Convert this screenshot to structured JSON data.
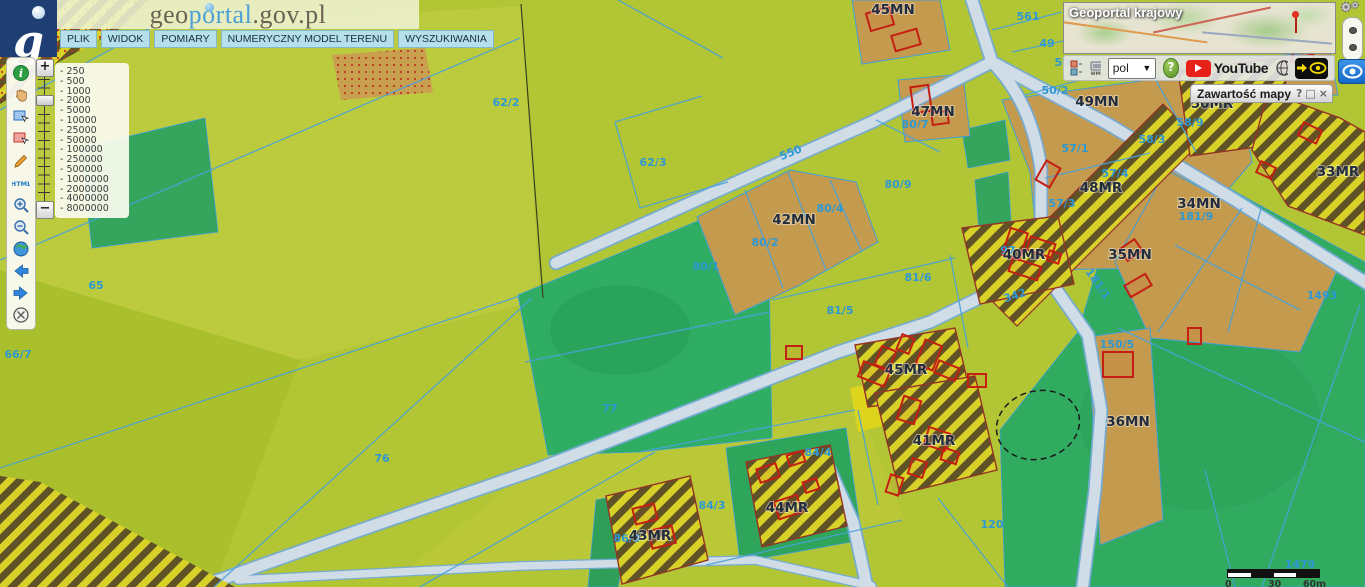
{
  "brand": {
    "logo_letter": "g",
    "site_prefix": "geo",
    "site_mid": "portal",
    "site_suffix": ".gov.pl"
  },
  "menu": {
    "items": [
      {
        "label": "PLIK"
      },
      {
        "label": "WIDOK"
      },
      {
        "label": "POMIARY"
      },
      {
        "label": "NUMERYCZNY MODEL TERENU"
      },
      {
        "label": "WYSZUKIWANIA"
      }
    ]
  },
  "left_toolbar": {
    "icons": [
      "info",
      "pan",
      "select-rectangle",
      "deselect-rectangle",
      "draw",
      "html-report",
      "zoom-in",
      "zoom-out",
      "full-extent",
      "previous-view",
      "next-view",
      "clear"
    ]
  },
  "zoom_control": {
    "plus_label": "+",
    "minus_label": "−",
    "scales": [
      "- 250",
      "- 500",
      "- 1000",
      "- 2000",
      "- 5000",
      "- 10000",
      "- 25000",
      "- 50000",
      "- 100000",
      "- 250000",
      "- 500000",
      "- 1000000",
      "- 2000000",
      "- 4000000",
      "- 8000000"
    ]
  },
  "overview": {
    "title": "Geoportal krajowy"
  },
  "top_toolbar": {
    "language_value": "pol",
    "help_label": "?",
    "youtube_label": "YouTube",
    "icons": [
      "legend-icon",
      "wms-icon",
      "language-select",
      "help-button",
      "youtube-button",
      "globe-grid-icon",
      "quick-view-arrow-icon",
      "quick-view-eye-icon"
    ]
  },
  "right_controls": {
    "icons": [
      "gears-icon",
      "panel-handle",
      "eye-icon"
    ]
  },
  "map_content_panel": {
    "title": "Zawartość mapy",
    "help_label": "?",
    "maximize_label": "□",
    "close_label": "×"
  },
  "scale_bar": {
    "labels": [
      "0",
      "30",
      "60m"
    ]
  },
  "map": {
    "colors": {
      "field": "#b2c534",
      "forest": "#2fae63",
      "residential": "#c49a4e",
      "hatch_yellow": "#d8d128",
      "hatch_dark": "#5f5226",
      "road": "#d0dce6",
      "road_edge": "#74abd6",
      "cadastral_line": "#48a2da",
      "building_outline": "#c41f12",
      "parcel_number": "#2e98d4",
      "zone_label": "#222c3c"
    },
    "zone_labels": [
      {
        "text": "45MN",
        "x": 893,
        "y": 14
      },
      {
        "text": "47MN",
        "x": 933,
        "y": 116
      },
      {
        "text": "49MN",
        "x": 1097,
        "y": 106
      },
      {
        "text": "50MR",
        "x": 1212,
        "y": 108
      },
      {
        "text": "48MR",
        "x": 1101,
        "y": 192
      },
      {
        "text": "42MN",
        "x": 794,
        "y": 224
      },
      {
        "text": "40MR",
        "x": 1024,
        "y": 259
      },
      {
        "text": "34MN",
        "x": 1199,
        "y": 208
      },
      {
        "text": "35MN",
        "x": 1130,
        "y": 259
      },
      {
        "text": "33MR",
        "x": 1338,
        "y": 176
      },
      {
        "text": "36MN",
        "x": 1128,
        "y": 426
      },
      {
        "text": "45MR",
        "x": 906,
        "y": 374
      },
      {
        "text": "41MR",
        "x": 934,
        "y": 445
      },
      {
        "text": "43MR",
        "x": 650,
        "y": 540
      },
      {
        "text": "44MR",
        "x": 787,
        "y": 512
      }
    ],
    "parcel_numbers": [
      {
        "text": "561",
        "x": 1028,
        "y": 20
      },
      {
        "text": "49",
        "x": 1047,
        "y": 47
      },
      {
        "text": "50/1",
        "x": 1068,
        "y": 66
      },
      {
        "text": "50/2",
        "x": 1055,
        "y": 94
      },
      {
        "text": "80/7",
        "x": 915,
        "y": 128
      },
      {
        "text": "80/9",
        "x": 898,
        "y": 188
      },
      {
        "text": "80/4",
        "x": 830,
        "y": 212
      },
      {
        "text": "80/2",
        "x": 765,
        "y": 246
      },
      {
        "text": "80/1",
        "x": 706,
        "y": 270
      },
      {
        "text": "81/6",
        "x": 918,
        "y": 281
      },
      {
        "text": "81/5",
        "x": 840,
        "y": 314
      },
      {
        "text": "62/2",
        "x": 506,
        "y": 106
      },
      {
        "text": "62/3",
        "x": 653,
        "y": 166
      },
      {
        "text": "65",
        "x": 96,
        "y": 289
      },
      {
        "text": "66/7",
        "x": 18,
        "y": 358
      },
      {
        "text": "76",
        "x": 382,
        "y": 462
      },
      {
        "text": "77",
        "x": 610,
        "y": 412
      },
      {
        "text": "84/3",
        "x": 712,
        "y": 509
      },
      {
        "text": "84/4",
        "x": 818,
        "y": 456
      },
      {
        "text": "86/3",
        "x": 627,
        "y": 542
      },
      {
        "text": "97",
        "x": 1008,
        "y": 254
      },
      {
        "text": "342",
        "x": 1016,
        "y": 299,
        "rot": -18
      },
      {
        "text": "550",
        "x": 792,
        "y": 156,
        "rot": -22
      },
      {
        "text": "150/5",
        "x": 1117,
        "y": 348
      },
      {
        "text": "181/9",
        "x": 1196,
        "y": 220
      },
      {
        "text": "181/1",
        "x": 1095,
        "y": 286,
        "rot": 55
      },
      {
        "text": "57/1",
        "x": 1075,
        "y": 152
      },
      {
        "text": "58/3",
        "x": 1152,
        "y": 143
      },
      {
        "text": "57/4",
        "x": 1115,
        "y": 177
      },
      {
        "text": "57/3",
        "x": 1062,
        "y": 207
      },
      {
        "text": "58/9",
        "x": 1190,
        "y": 126,
        "color": "#55a438"
      },
      {
        "text": "120",
        "x": 992,
        "y": 528
      },
      {
        "text": "1479",
        "x": 1300,
        "y": 568,
        "size": 9
      },
      {
        "text": "1493",
        "x": 1322,
        "y": 299,
        "color": "#55a438"
      }
    ],
    "buildings": [
      [
        868,
        10,
        24,
        18,
        -16
      ],
      [
        893,
        32,
        26,
        16,
        -16
      ],
      [
        912,
        86,
        18,
        26,
        -8
      ],
      [
        932,
        112,
        16,
        12,
        -8
      ],
      [
        1292,
        52,
        20,
        12,
        15
      ],
      [
        1006,
        230,
        18,
        28,
        18
      ],
      [
        1028,
        240,
        26,
        14,
        18
      ],
      [
        1010,
        262,
        30,
        14,
        18
      ],
      [
        1048,
        252,
        12,
        10,
        18
      ],
      [
        1040,
        163,
        16,
        22,
        30
      ],
      [
        1122,
        243,
        18,
        14,
        -35
      ],
      [
        1126,
        279,
        24,
        13,
        -30
      ],
      [
        1188,
        328,
        13,
        16,
        0
      ],
      [
        1300,
        126,
        20,
        14,
        25
      ],
      [
        1258,
        164,
        16,
        12,
        25
      ],
      [
        1103,
        352,
        30,
        25,
        0
      ],
      [
        878,
        348,
        15,
        20,
        22
      ],
      [
        899,
        336,
        13,
        16,
        22
      ],
      [
        920,
        342,
        18,
        26,
        22
      ],
      [
        936,
        364,
        22,
        13,
        22
      ],
      [
        860,
        366,
        28,
        16,
        22
      ],
      [
        900,
        398,
        18,
        24,
        18
      ],
      [
        926,
        430,
        22,
        18,
        18
      ],
      [
        910,
        460,
        15,
        16,
        18
      ],
      [
        942,
        450,
        16,
        12,
        18
      ],
      [
        888,
        476,
        13,
        18,
        18
      ],
      [
        634,
        506,
        22,
        16,
        -14
      ],
      [
        650,
        528,
        24,
        18,
        -14
      ],
      [
        758,
        466,
        20,
        14,
        -18
      ],
      [
        788,
        453,
        16,
        11,
        -18
      ],
      [
        776,
        498,
        24,
        18,
        -18
      ],
      [
        804,
        480,
        14,
        11,
        -18
      ],
      [
        786,
        346,
        16,
        13,
        0
      ],
      [
        968,
        374,
        18,
        13,
        0
      ]
    ]
  }
}
